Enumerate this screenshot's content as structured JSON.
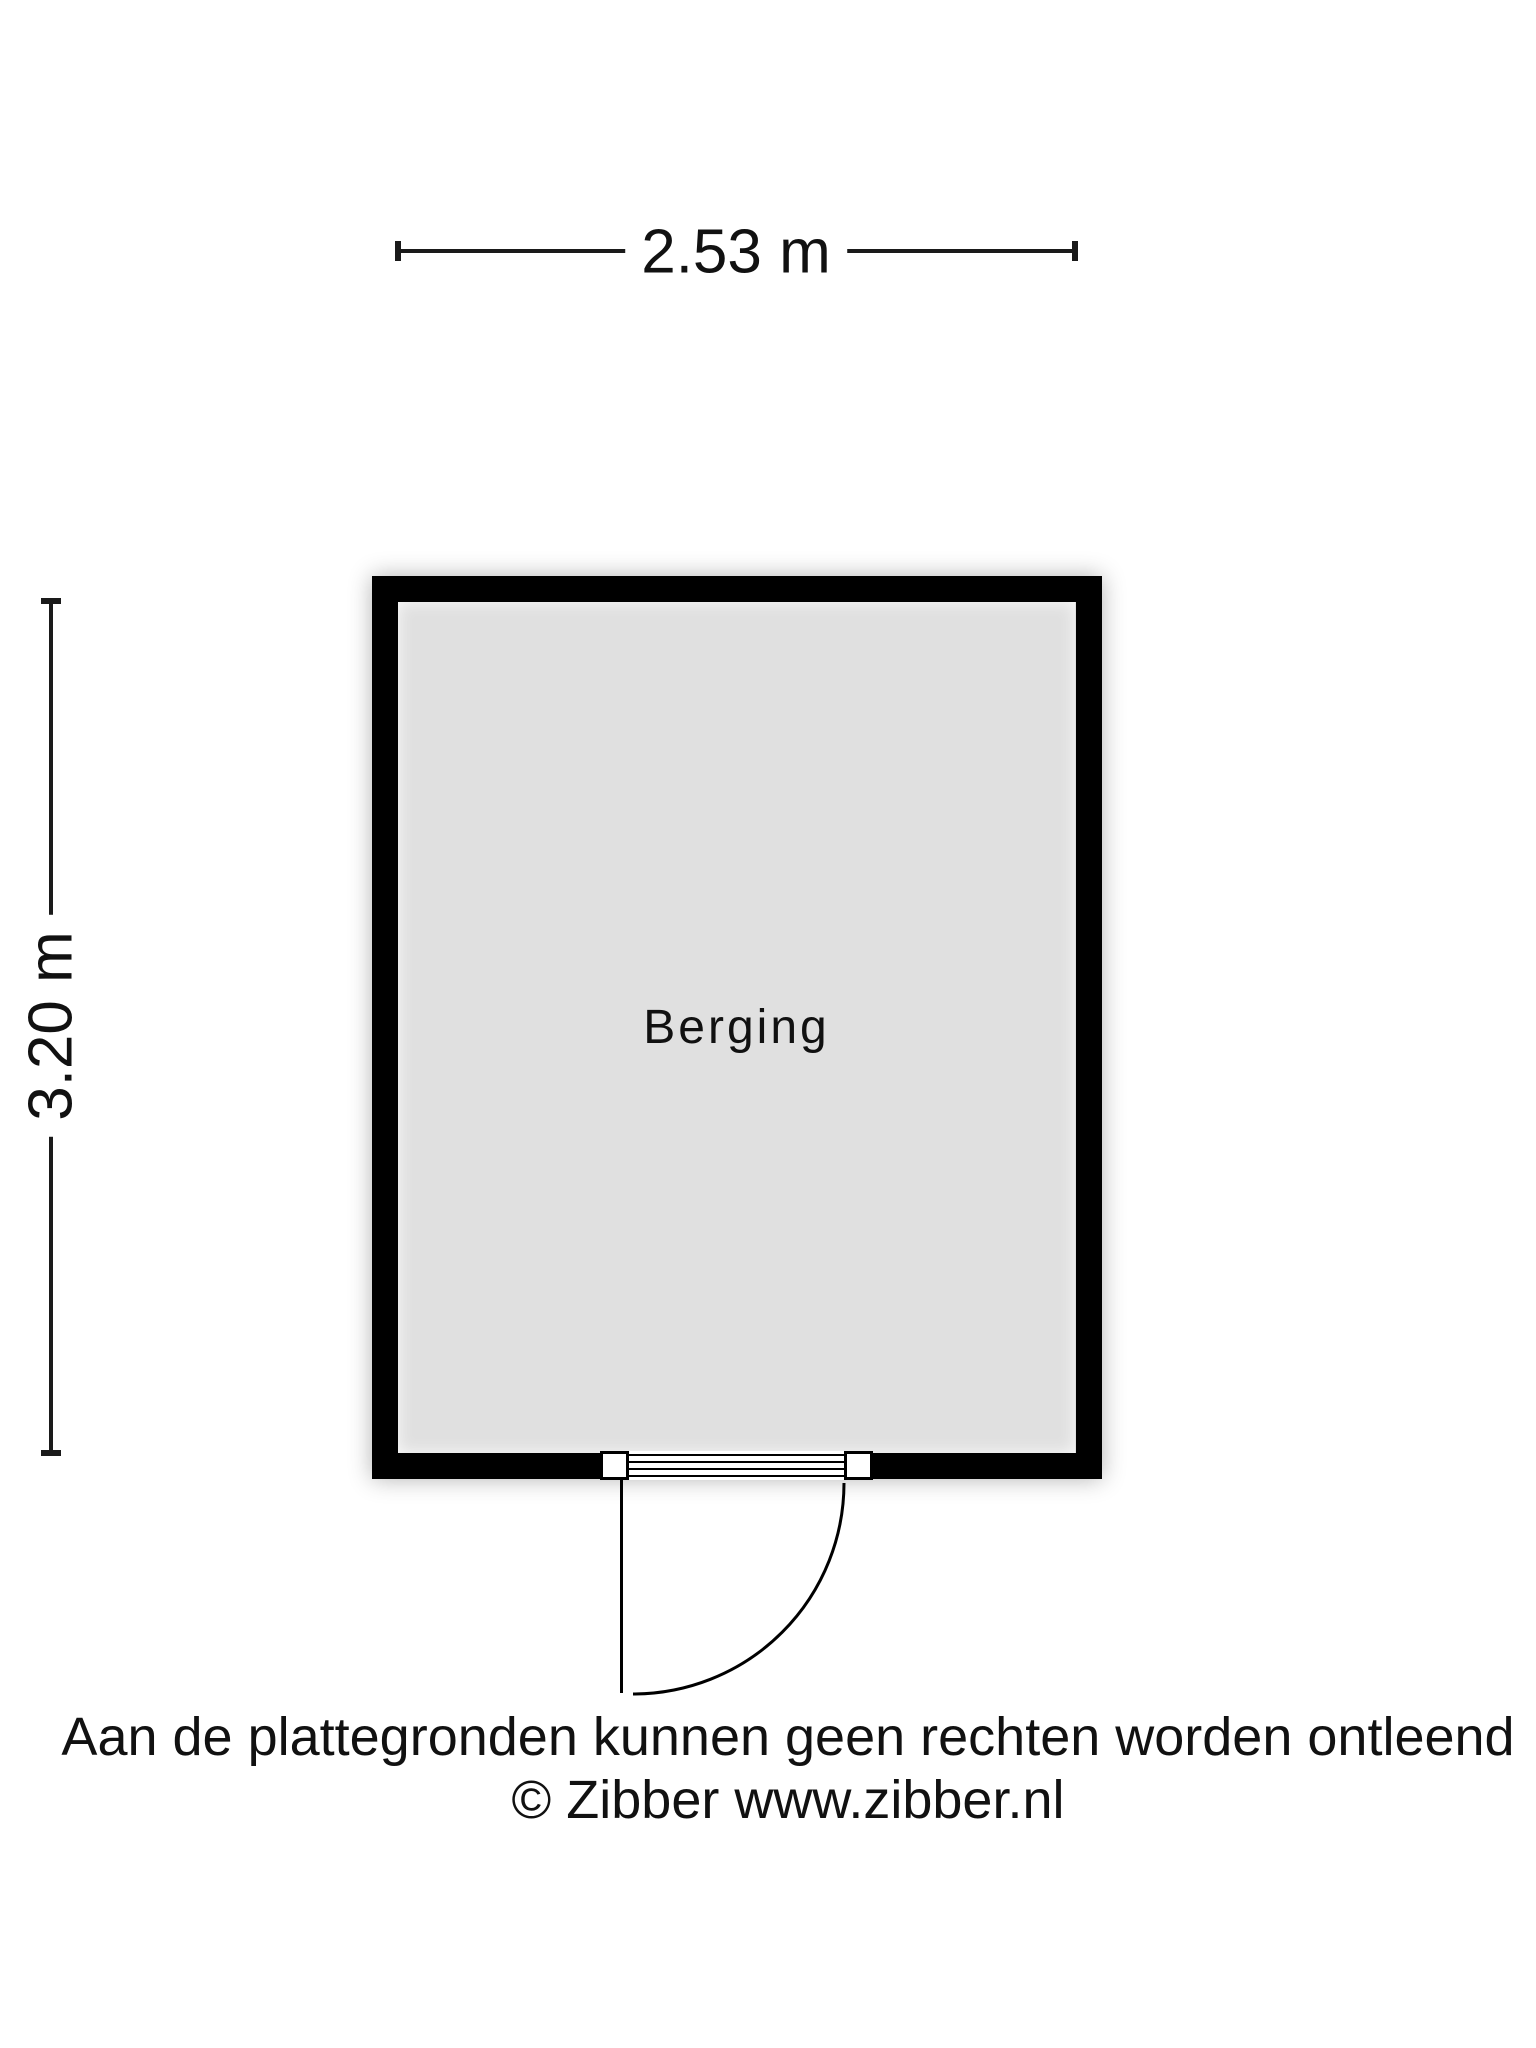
{
  "floorplan": {
    "room_label": "Berging",
    "dimensions": {
      "width_label": "2.53 m",
      "height_label": "3.20 m"
    }
  },
  "footer": {
    "disclaimer": "Aan de plattegronden kunnen geen rechten worden ontleend",
    "copyright": "© Zibber www.zibber.nl"
  },
  "colors": {
    "wall": "#000000",
    "room_fill": "#e0e0e0",
    "background": "#ffffff",
    "text": "#111111"
  }
}
